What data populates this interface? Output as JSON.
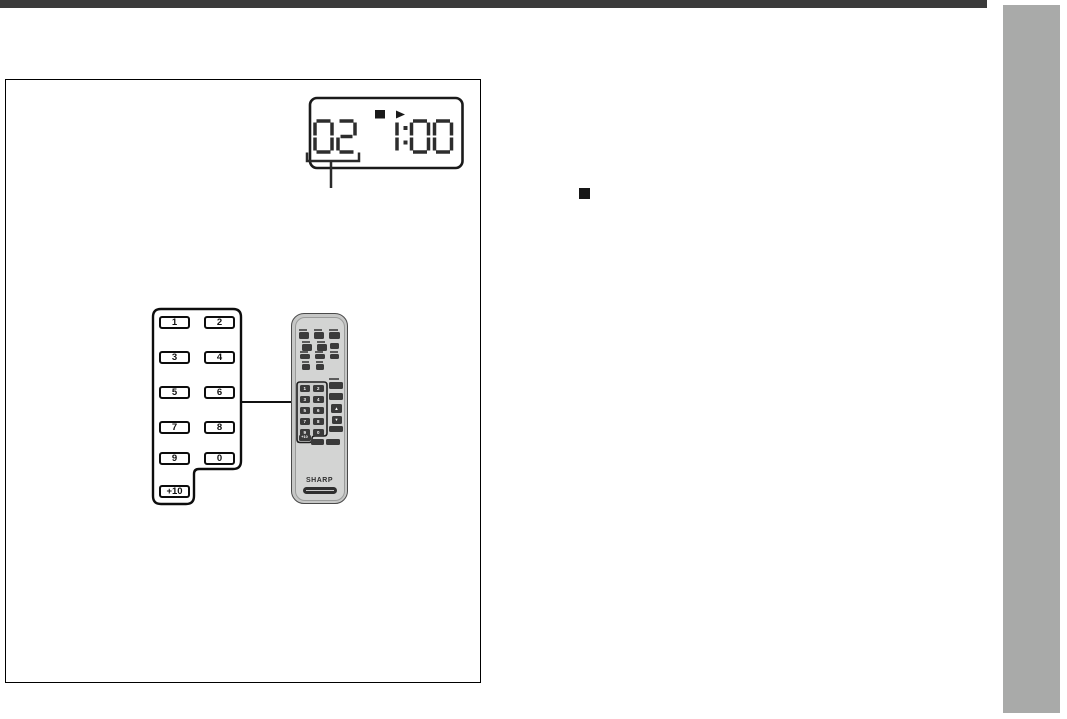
{
  "page": {
    "type": "instruction-manual-page",
    "top_rule_color": "#3b3b3b",
    "side_tab_color": "#a9aaa9",
    "section_bullet": "filled-square"
  },
  "figure": {
    "display": {
      "track_number": "02",
      "time": "1:00",
      "stop_icon": "filled-square",
      "play_icon": "right-triangle",
      "digit_color": "#2d2d2d"
    },
    "keypad_diagram": {
      "buttons": [
        "1",
        "2",
        "3",
        "4",
        "5",
        "6",
        "7",
        "8",
        "9",
        "0",
        "+10"
      ]
    },
    "remote": {
      "brand": "SHARP",
      "number_buttons": [
        "1",
        "2",
        "3",
        "4",
        "5",
        "6",
        "7",
        "8",
        "9",
        "0",
        "+10"
      ],
      "side_buttons": [
        "up",
        "down"
      ]
    }
  }
}
